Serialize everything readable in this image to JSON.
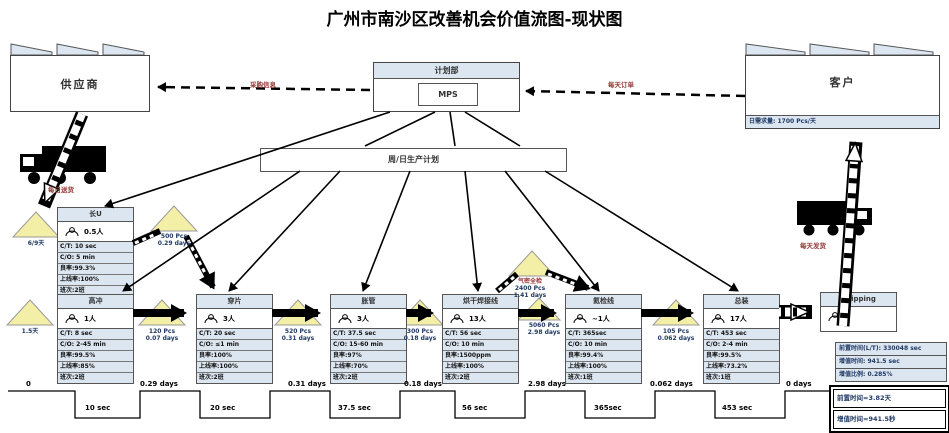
{
  "title": "广州市南沙区改善机会价值流图-现状图",
  "supplier": {
    "label": "供应商"
  },
  "customer": {
    "label": "客户",
    "demand": "日需求量: 1700 Pcs/天"
  },
  "planning": {
    "label": "计划部",
    "mps": "MPS"
  },
  "schedule": {
    "label": "周/日生产计划"
  },
  "flows": {
    "purchase_info": "采购信息",
    "daily_order": "每天订单",
    "daily_delivery": "每日送货",
    "daily_ship": "每天发货"
  },
  "processes": [
    {
      "name": "长U",
      "operators": "0.5人",
      "rows": [
        "C/T: 10 sec",
        "C/O: 5 min",
        "良率:99.3%",
        "上线率:100%",
        "班次:2班"
      ]
    },
    {
      "name": "高冲",
      "operators": "1人",
      "rows": [
        "C/T: 8 sec",
        "C/O: 2-45 min",
        "良率:99.5%",
        "上线率:85%",
        "班次:2班"
      ]
    },
    {
      "name": "穿片",
      "operators": "3人",
      "rows": [
        "C/T: 20 sec",
        "C/O: ≤1 min",
        "良率:100%",
        "上线率:100%",
        "班次:2班"
      ]
    },
    {
      "name": "胀管",
      "operators": "3人",
      "rows": [
        "C/T: 37.5 sec",
        "C/O: 15-60 min",
        "良率:97%",
        "上线率:70%",
        "班次:2班"
      ]
    },
    {
      "name": "烘干焊接线",
      "operators": "13人",
      "rows": [
        "C/T: 56 sec",
        "C/O: 10 min",
        "良率:1500ppm",
        "上线率:100%",
        "班次:2班"
      ]
    },
    {
      "name": "氦检线",
      "operators": "~1人",
      "rows": [
        "C/T: 365sec",
        "C/O: 10 min",
        "良率:99.4%",
        "上线率:100%",
        "班次:1班"
      ]
    },
    {
      "name": "总装",
      "operators": "17人",
      "rows": [
        "C/T: 453 sec",
        "C/O: 2-4 min",
        "良率:99.5%",
        "上线率:73.2%",
        "班次:1班"
      ]
    },
    {
      "name": "Shipping",
      "operators": ""
    }
  ],
  "inventories": [
    {
      "line1": "6/9天",
      "line2": ""
    },
    {
      "line1": "500 Pcs",
      "line2": "0.29 days"
    },
    {
      "line1": "120 Pcs",
      "line2": "0.07 days"
    },
    {
      "line1": "1.5天",
      "line2": ""
    },
    {
      "line1": "520 Pcs",
      "line2": "0.31 days"
    },
    {
      "line1": "300 Pcs",
      "line2": "0.18 days"
    },
    {
      "line1": "气密全检",
      "line2": "2400 Pcs",
      "line3": "1.41 days"
    },
    {
      "line1": "5060 Pcs",
      "line2": "2.98 days"
    },
    {
      "line1": "105 Pcs",
      "line2": "0.062 days"
    }
  ],
  "timeline": {
    "wait_labels": [
      "0",
      "0.29 days",
      "0.31 days",
      "0.18 days",
      "2.98 days",
      "0.062 days",
      "0 days"
    ],
    "process_labels": [
      "10 sec",
      "20 sec",
      "37.5 sec",
      "56 sec",
      "365sec",
      "453 sec"
    ]
  },
  "summary": {
    "rows": [
      "前置时间(L/T): 330048 sec",
      "增值时间: 941.5 sec",
      "增值比例: 0.285%"
    ],
    "notes": [
      "前置时间=3.82天",
      "增值时间=941.5秒"
    ]
  }
}
